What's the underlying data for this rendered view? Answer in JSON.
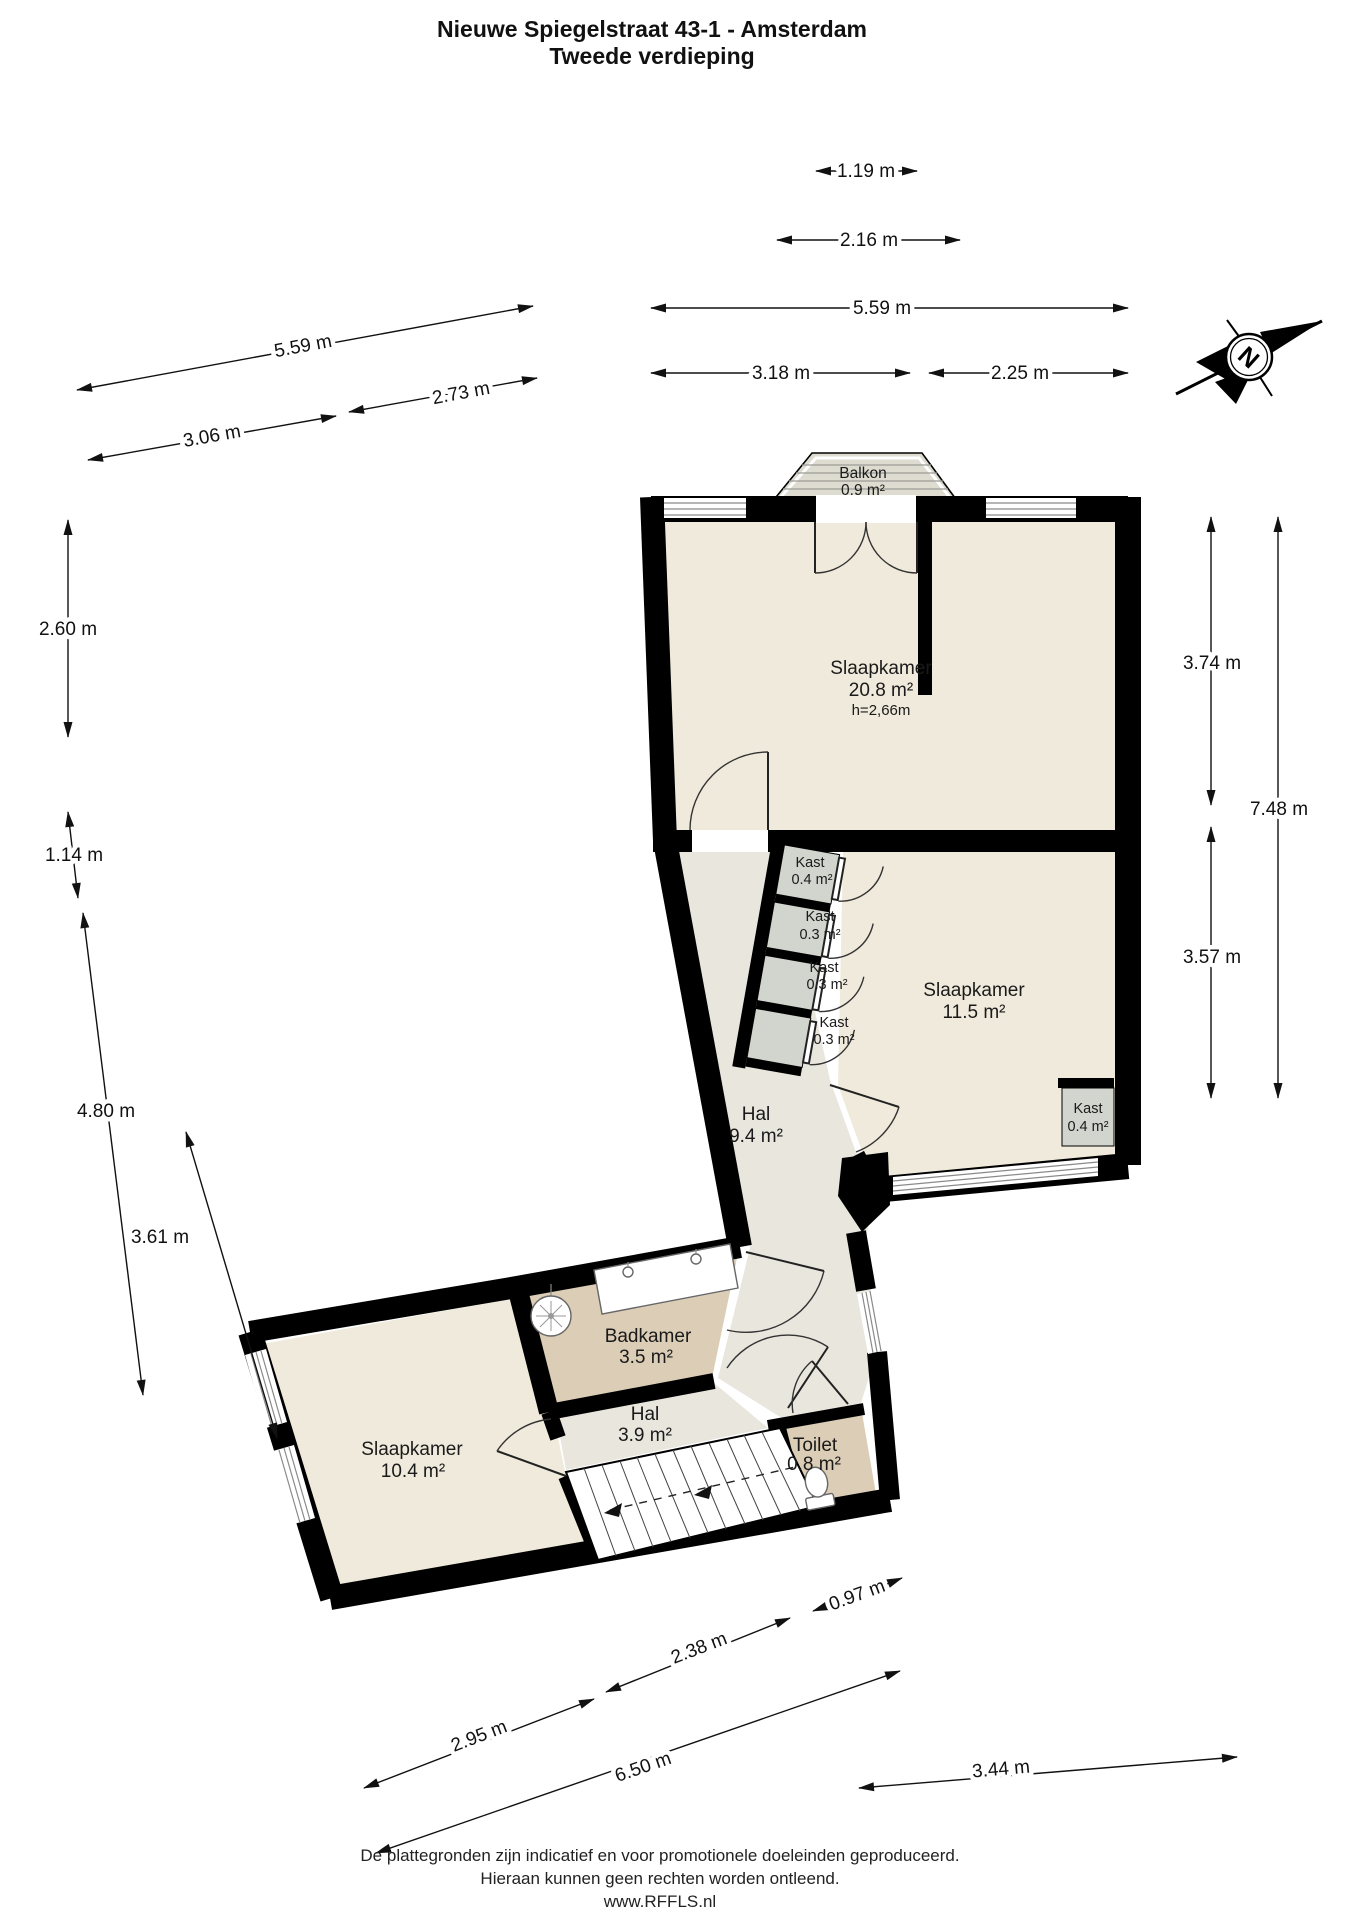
{
  "title": {
    "line1": "Nieuwe Spiegelstraat 43-1 - Amsterdam",
    "line2": "Tweede verdieping"
  },
  "rooms": [
    {
      "name": "Slaapkamer",
      "area": "20.8 m²",
      "height": "h=2,66m"
    },
    {
      "name": "Slaapkamer",
      "area": "11.5 m²"
    },
    {
      "name": "Hal",
      "area": "9.4 m²"
    },
    {
      "name": "Badkamer",
      "area": "3.5 m²"
    },
    {
      "name": "Hal",
      "area": "3.9 m²"
    },
    {
      "name": "Toilet",
      "area": "0.8 m²"
    },
    {
      "name": "Slaapkamer",
      "area": "10.4 m²"
    }
  ],
  "balcony": {
    "name": "Balkon",
    "area": "0.9 m²"
  },
  "closets": [
    {
      "name": "Kast",
      "area": "0.4 m²"
    },
    {
      "name": "Kast",
      "area": "0.3 m²"
    },
    {
      "name": "Kast",
      "area": "0.3 m²"
    },
    {
      "name": "Kast",
      "area": "0.3 m²"
    },
    {
      "name": "Kast",
      "area": "0.4 m²"
    }
  ],
  "compass": {
    "label": "N"
  },
  "dimensions": {
    "top": [
      {
        "label": "1.19 m"
      },
      {
        "label": "2.16 m"
      },
      {
        "label": "5.59 m"
      },
      {
        "label": "3.18 m"
      },
      {
        "label": "2.25 m"
      }
    ],
    "left_slanted": [
      {
        "label": "5.59 m"
      },
      {
        "label": "2.73 m"
      },
      {
        "label": "3.06 m"
      }
    ],
    "left": [
      {
        "label": "2.60 m"
      },
      {
        "label": "1.14 m"
      },
      {
        "label": "4.80 m"
      },
      {
        "label": "3.61 m"
      }
    ],
    "right": [
      {
        "label": "3.74 m"
      },
      {
        "label": "7.48 m"
      },
      {
        "label": "3.57 m"
      }
    ],
    "bottom": [
      {
        "label": "0.97 m"
      },
      {
        "label": "2.38 m"
      },
      {
        "label": "2.95 m"
      },
      {
        "label": "6.50 m"
      },
      {
        "label": "3.44 m"
      }
    ]
  },
  "footer": {
    "line1": "De plattegronden zijn indicatief en voor promotionele doeleinden geproduceerd.",
    "line2": "Hieraan kunnen geen rechten worden ontleend.",
    "line3": "www.RFFLS.nl"
  },
  "colors": {
    "wall": "#000000",
    "room_fill": "#efeadb",
    "hall_fill": "#e9e6de",
    "bathroom_fill": "#dbcdb6",
    "closet_fill": "#d2d4ce",
    "balcony_fill": "#dedcd1"
  }
}
